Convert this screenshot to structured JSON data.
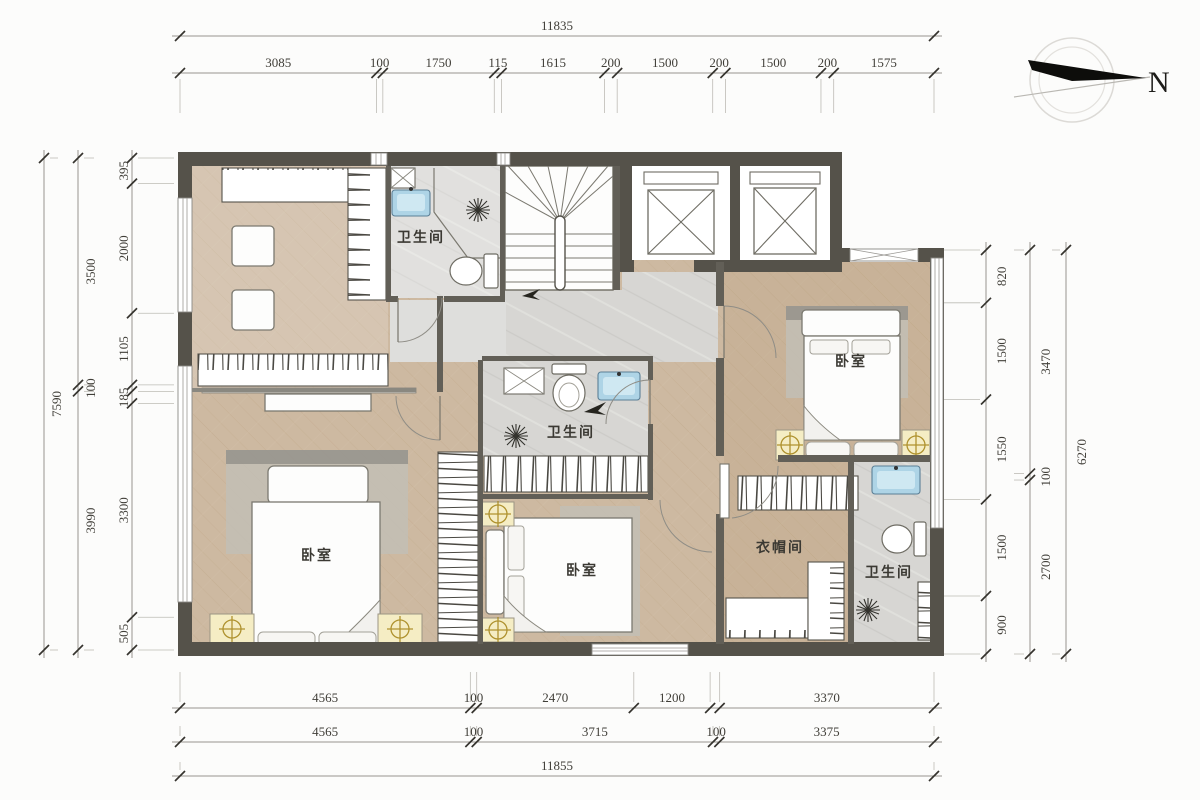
{
  "compass": {
    "north_label": "N"
  },
  "rooms": {
    "bathroom_top": {
      "label": "卫生间"
    },
    "bathroom_middle": {
      "label": "卫生间"
    },
    "bathroom_right": {
      "label": "卫生间"
    },
    "bedroom_left": {
      "label": "卧室"
    },
    "bedroom_middle": {
      "label": "卧室"
    },
    "bedroom_right": {
      "label": "卧室"
    },
    "cloakroom": {
      "label": "衣帽间"
    }
  },
  "dimensions": {
    "top_total": [
      {
        "v": 11835,
        "l": "11835"
      }
    ],
    "top_segments": [
      {
        "v": 3085,
        "l": "3085"
      },
      {
        "v": 100,
        "l": "100"
      },
      {
        "v": 1750,
        "l": "1750"
      },
      {
        "v": 115,
        "l": "115"
      },
      {
        "v": 1615,
        "l": "1615"
      },
      {
        "v": 200,
        "l": "200"
      },
      {
        "v": 1500,
        "l": "1500"
      },
      {
        "v": 200,
        "l": "200"
      },
      {
        "v": 1500,
        "l": "1500"
      },
      {
        "v": 200,
        "l": "200"
      },
      {
        "v": 1575,
        "l": "1575"
      }
    ],
    "bottom_upper": [
      {
        "v": 4565,
        "l": "4565"
      },
      {
        "v": 100,
        "l": "100"
      },
      {
        "v": 2470,
        "l": "2470"
      },
      {
        "v": 1200,
        "l": "1200"
      },
      {
        "v": 150,
        "l": ""
      },
      {
        "v": 3370,
        "l": "3370"
      }
    ],
    "bottom_lower": [
      {
        "v": 4565,
        "l": "4565"
      },
      {
        "v": 100,
        "l": "100"
      },
      {
        "v": 3715,
        "l": "3715"
      },
      {
        "v": 100,
        "l": "100"
      },
      {
        "v": 3375,
        "l": "3375"
      }
    ],
    "bottom_total": [
      {
        "v": 11855,
        "l": "11855"
      }
    ],
    "left_outer": [
      {
        "v": 7590,
        "l": "7590"
      }
    ],
    "left_middle": [
      {
        "v": 3500,
        "l": "3500"
      },
      {
        "v": 100,
        "l": "100"
      },
      {
        "v": 3990,
        "l": "3990"
      }
    ],
    "left_inner": [
      {
        "v": 395,
        "l": "395"
      },
      {
        "v": 2000,
        "l": "2000"
      },
      {
        "v": 1105,
        "l": "1105"
      },
      {
        "v": 100,
        "l": ""
      },
      {
        "v": 185,
        "l": "185"
      },
      {
        "v": 3300,
        "l": "3300"
      },
      {
        "v": 505,
        "l": "505"
      }
    ],
    "right_inner": [
      {
        "v": 820,
        "l": "820"
      },
      {
        "v": 1500,
        "l": "1500"
      },
      {
        "v": 1550,
        "l": "1550"
      },
      {
        "v": 1500,
        "l": "1500"
      },
      {
        "v": 900,
        "l": "900"
      }
    ],
    "right_middle": [
      {
        "v": 3470,
        "l": "3470"
      },
      {
        "v": 100,
        "l": "100"
      },
      {
        "v": 2700,
        "l": "2700"
      }
    ],
    "right_outer": [
      {
        "v": 6270,
        "l": "6270"
      }
    ]
  },
  "icons": {
    "shower": "radial-fan-lines",
    "bedside_lamp": "circle-with-cross",
    "north_arrow": "black-dart",
    "elevator": "box-with-x",
    "wardrobe": "hanger-hatch-marks"
  },
  "colors": {
    "wall": "#55524a",
    "wood_floor": "#cdb9a1",
    "wood_floor_right": "#c4ab8e",
    "tile_floor": "#d7d6d3",
    "bath_floor": "#dbdad8",
    "sink_blue": "#aed4e6",
    "lamp_gold": "#a8891f",
    "dimension_text": "#403e38"
  }
}
